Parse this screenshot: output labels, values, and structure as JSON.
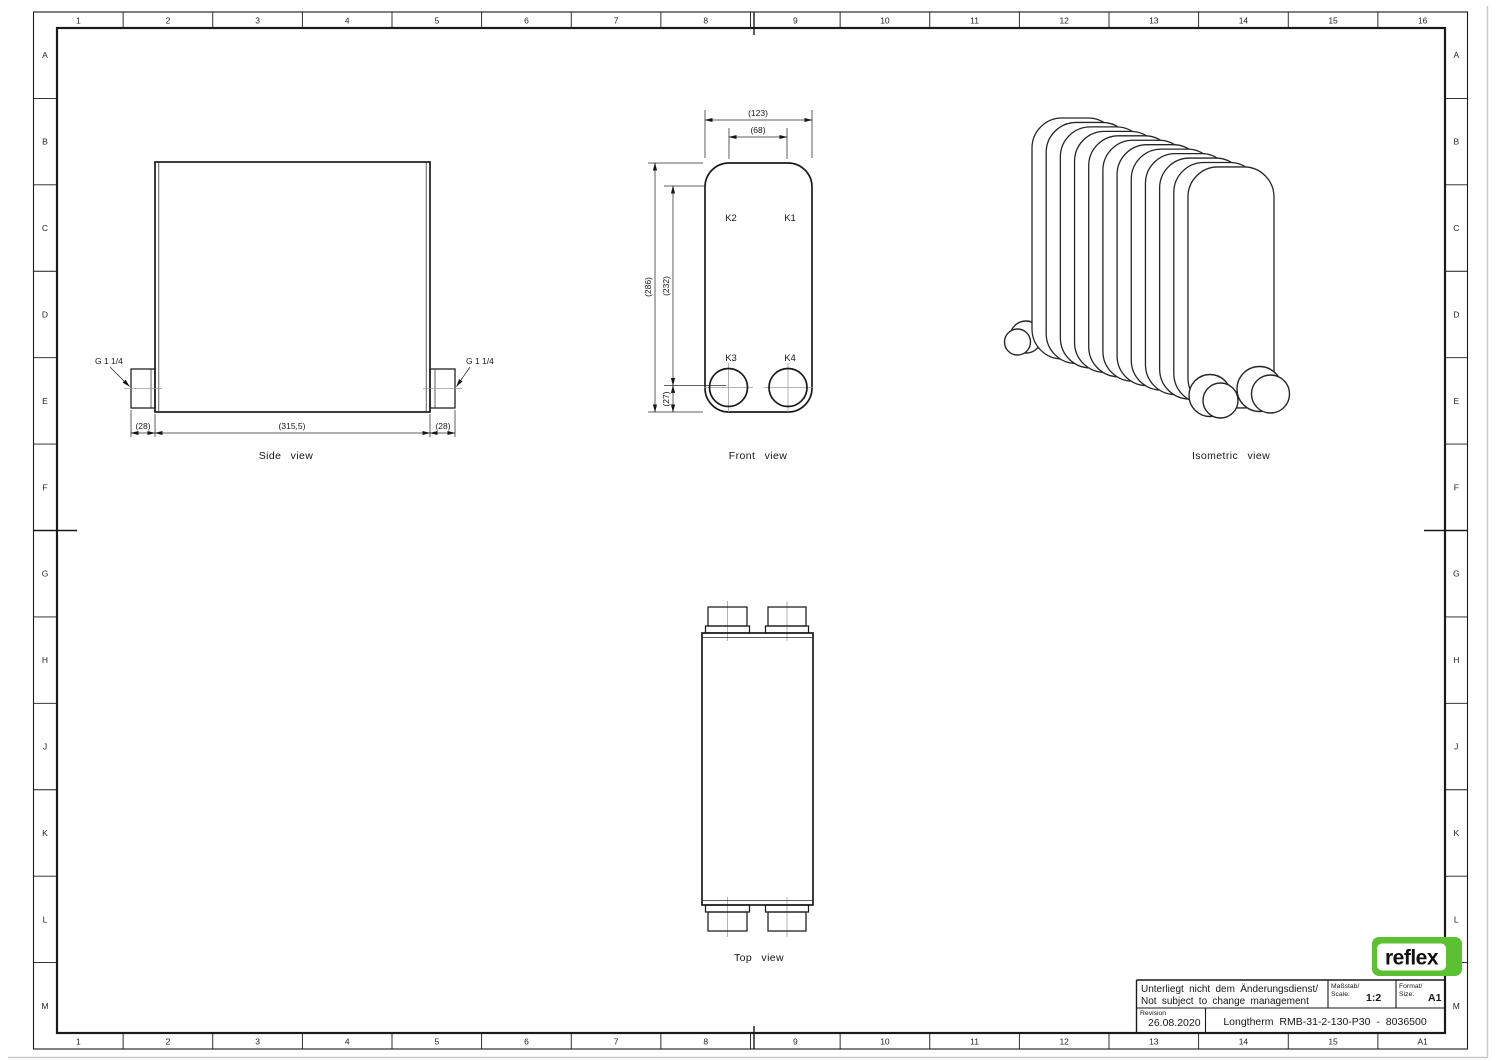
{
  "rulers": {
    "cols_top": [
      "1",
      "2",
      "3",
      "4",
      "5",
      "6",
      "7",
      "8",
      "9",
      "10",
      "11",
      "12",
      "13",
      "14",
      "15",
      "16"
    ],
    "cols_bottom": [
      "1",
      "2",
      "3",
      "4",
      "5",
      "6",
      "7",
      "8",
      "9",
      "10",
      "11",
      "12",
      "13",
      "14",
      "15",
      "A1"
    ],
    "rows_left": [
      "A",
      "B",
      "C",
      "D",
      "E",
      "F",
      "G",
      "H",
      "J",
      "K",
      "L",
      "M"
    ],
    "rows_right": [
      "A",
      "B",
      "C",
      "D",
      "E",
      "F",
      "G",
      "H",
      "J",
      "K",
      "L",
      "M"
    ]
  },
  "views": {
    "side": {
      "label": "Side view",
      "thread_left": "G 1 1/4",
      "thread_right": "G 1 1/4",
      "dim_left": "(28)",
      "dim_center": "(315,5)",
      "dim_right": "(28)"
    },
    "front": {
      "label": "Front view",
      "dim_width": "(123)",
      "dim_ports": "(68)",
      "dim_height": "(286)",
      "dim_span": "(232)",
      "dim_bottom": "(27)",
      "k1": "K1",
      "k2": "K2",
      "k3": "K3",
      "k4": "K4"
    },
    "iso": {
      "label": "Isometric view"
    },
    "top": {
      "label": "Top view"
    }
  },
  "title_block": {
    "note_line1": "Unterliegt nicht dem Änderungsdienst/",
    "note_line2": "Not subject to change management",
    "scale_label_de": "Maßstab/",
    "scale_label_en": "Scale:",
    "scale_value": "1:2",
    "format_label_de": "Format/",
    "format_label_en": "Size:",
    "format_value": "A1",
    "revision_label": "Revision",
    "revision_date": "26.08.2020",
    "title": "Longtherm RMB-31-2-130-P30 - 8036500"
  },
  "logo": {
    "text": "reflex",
    "green": "#5cc033"
  }
}
